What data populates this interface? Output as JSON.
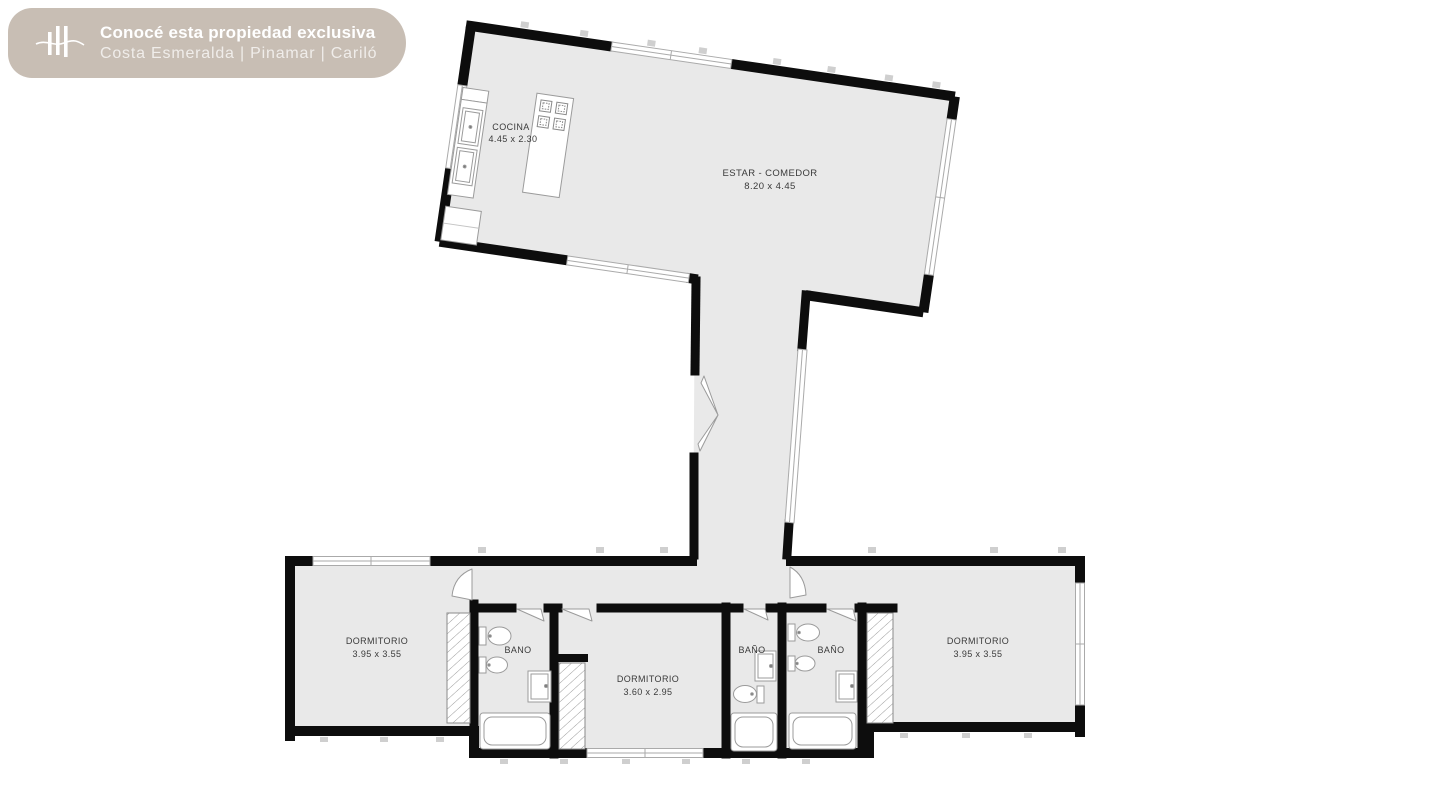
{
  "banner": {
    "title": "Conocé esta propiedad exclusiva",
    "subtitle": "Costa Esmeralda | Pinamar | Cariló",
    "background": "#c8beb4",
    "logo": "three-bars-wave-icon"
  },
  "floorplan": {
    "colors": {
      "floor": "#e9e9e9",
      "wall": "#0d0d0d",
      "fixture_outline": "#9b9b9b",
      "label_text": "#3a3a3a",
      "tick": "#cfcfcf"
    },
    "rooms": [
      {
        "id": "cocina",
        "label": "COCINA",
        "dimensions": "4.45 x 2.30"
      },
      {
        "id": "estar_comedor",
        "label": "ESTAR - COMEDOR",
        "dimensions": "8.20 x 4.45"
      },
      {
        "id": "dormitorio_izq",
        "label": "DORMITORIO",
        "dimensions": "3.95 x 3.55"
      },
      {
        "id": "bano_izq",
        "label": "BANO",
        "dimensions": ""
      },
      {
        "id": "dormitorio_centro",
        "label": "DORMITORIO",
        "dimensions": "3.60 x 2.95"
      },
      {
        "id": "bano_1",
        "label": "BAÑO",
        "dimensions": ""
      },
      {
        "id": "bano_2",
        "label": "BAÑO",
        "dimensions": ""
      },
      {
        "id": "dormitorio_der",
        "label": "DORMITORIO",
        "dimensions": "3.95 x 3.55"
      }
    ]
  }
}
